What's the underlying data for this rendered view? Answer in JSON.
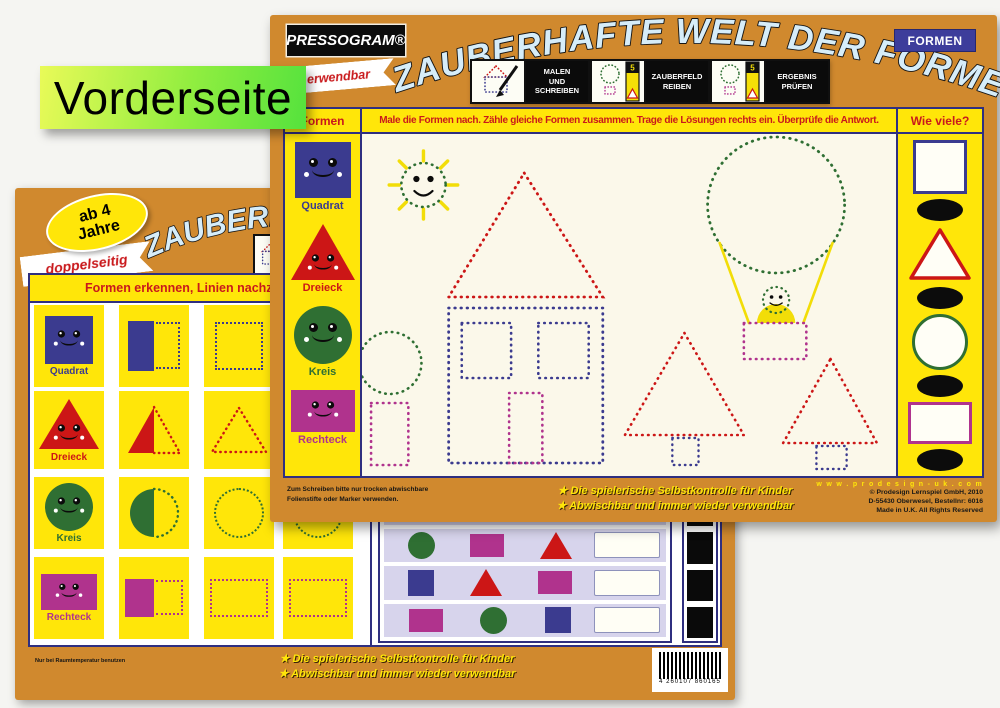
{
  "annotation": {
    "label": "Vorderseite"
  },
  "front_card": {
    "brand": "PRESSOGRAM®",
    "title": "ZAUBERHAFTE WELT DER FORMEN",
    "corner_badge": "FORMEN",
    "ribbon_fragment": "erwendbar",
    "steps": [
      {
        "label": "MALEN\nUND\nSCHREIBEN"
      },
      {
        "label": "ZAUBERFELD\nREIBEN"
      },
      {
        "label": "ERGEBNIS\nPRÜFEN"
      }
    ],
    "zauberfeld_badge": "5",
    "sidebar": {
      "header": "Formen",
      "shapes": [
        {
          "name": "Quadrat",
          "type": "square",
          "color": "#3b3b8f"
        },
        {
          "name": "Dreieck",
          "type": "triangle",
          "color": "#cc1616"
        },
        {
          "name": "Kreis",
          "type": "circle",
          "color": "#2f6f33"
        },
        {
          "name": "Rechteck",
          "type": "rectangle",
          "color": "#b0338d"
        }
      ]
    },
    "instruction": "Male die Formen nach. Zähle gleiche Formen zusammen. Trage die Lösungen rechts ein. Überprüfe die Antwort.",
    "answers": {
      "header": "Wie viele?",
      "items": [
        "square",
        "triangle",
        "circle",
        "rectangle"
      ]
    },
    "scene_objects": [
      "sun",
      "house",
      "tree",
      "hot-air-balloon",
      "fir-tree",
      "fir-tree"
    ],
    "footer_note_line1": "Zum Schreiben bitte nur trocken abwischbare",
    "footer_note_line2": "Folienstifte oder Marker verwenden.",
    "footer_bullet1": "★ Die spielerische Selbstkontrolle für Kinder",
    "footer_bullet2": "★ Abwischbar und immer wieder verwendbar",
    "credits": {
      "website": "w w w . p r o d e s i g n - u k . c o m",
      "line1": "© Prodesign Lernspiel GmbH, 2010",
      "line2": "D-55430 Oberwesel, Bestellnr: 6016",
      "line3": "Made in U.K.  All Rights Reserved"
    }
  },
  "back_card": {
    "age_badge": "ab 4\nJahre",
    "ribbon": "doppelseitig",
    "title_fragment": "ZAUBERH",
    "instruction_fragment": "Formen erkennen, Linien nachziehen und fehlende S",
    "grid_labels": [
      "Quadrat",
      "Dreieck",
      "Kreis",
      "Rechteck"
    ],
    "grid_columns": [
      "solid-with-face",
      "half-solid-half-dotted",
      "dotted-outline",
      "dotted-outline"
    ],
    "table_rows": [
      [
        "triangle",
        "square",
        "circle"
      ],
      [
        "circle",
        "rectangle",
        "triangle"
      ],
      [
        "square",
        "triangle",
        "rectangle"
      ],
      [
        "rectangle",
        "circle",
        "square"
      ]
    ],
    "footer_note": "Nur bei Raumtemperatur benutzen",
    "footer_bullet1": "★ Die spielerische Selbstkontrolle für Kinder",
    "footer_bullet2": "★ Abwischbar und immer wieder verwendbar",
    "barcode_digits": "4 260107 860165"
  },
  "colors": {
    "card_orange": "#d0892e",
    "panel_yellow": "#ffe609",
    "navy": "#3b3b8f",
    "red": "#cc1616",
    "green": "#2f6f33",
    "magenta": "#b0338d",
    "lavender": "#d7d4ec",
    "cream": "#fbf8ea",
    "title_letters": "#d6edf9",
    "annotation_green": "#7ce73f",
    "badge_blue": "#3d3d9b"
  }
}
